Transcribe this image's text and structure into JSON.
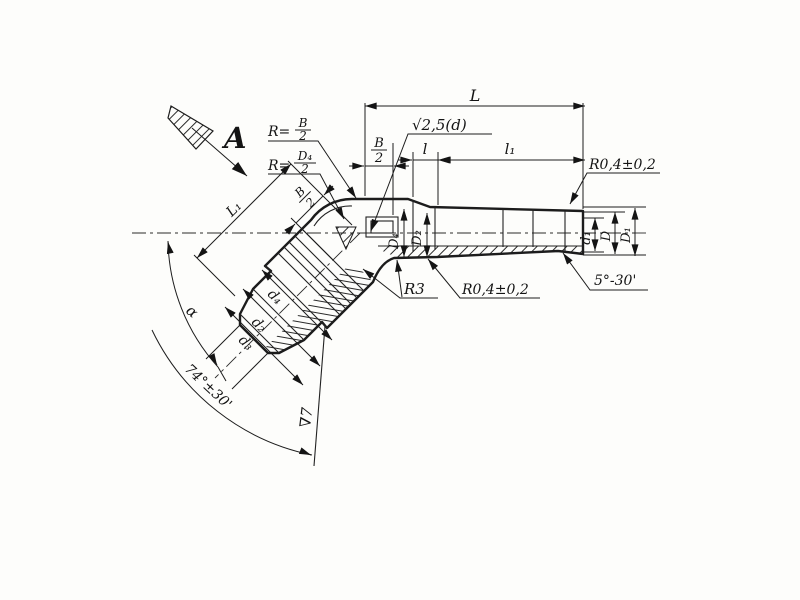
{
  "drawing": {
    "view_direction_label": "A",
    "callouts": {
      "bend_radius_outer": {
        "prefix": "R=",
        "num": "B",
        "den": "2"
      },
      "bend_radius_inner": {
        "prefix": "R=",
        "num": "D₄",
        "den": "2"
      },
      "surface_roughness_bore": "√2,5(d)",
      "fillet_top_right": "R0,4±0,2",
      "fillet_inner": "R3",
      "fillet_bottom": "R0,4±0,2",
      "taper_angle": "5°-30'",
      "surface_finish_class": "∇7"
    },
    "dimensions": {
      "length_total": "L",
      "half_width": {
        "num": "B",
        "den": "2"
      },
      "length_l": "l",
      "length_l1": "l₁",
      "bore_d1": "d₁",
      "outer_D": "D",
      "outer_D1": "D₁",
      "body_D4": "D₄",
      "body_D2": "D₂",
      "branch_length": "L₁",
      "branch_half_width": {
        "num": "B",
        "den": "2"
      },
      "branch_d4": "d₄",
      "branch_d2": "d₂",
      "branch_d3": "d₃",
      "bend_angle": "α",
      "cone_angle": "74°±30'"
    }
  }
}
